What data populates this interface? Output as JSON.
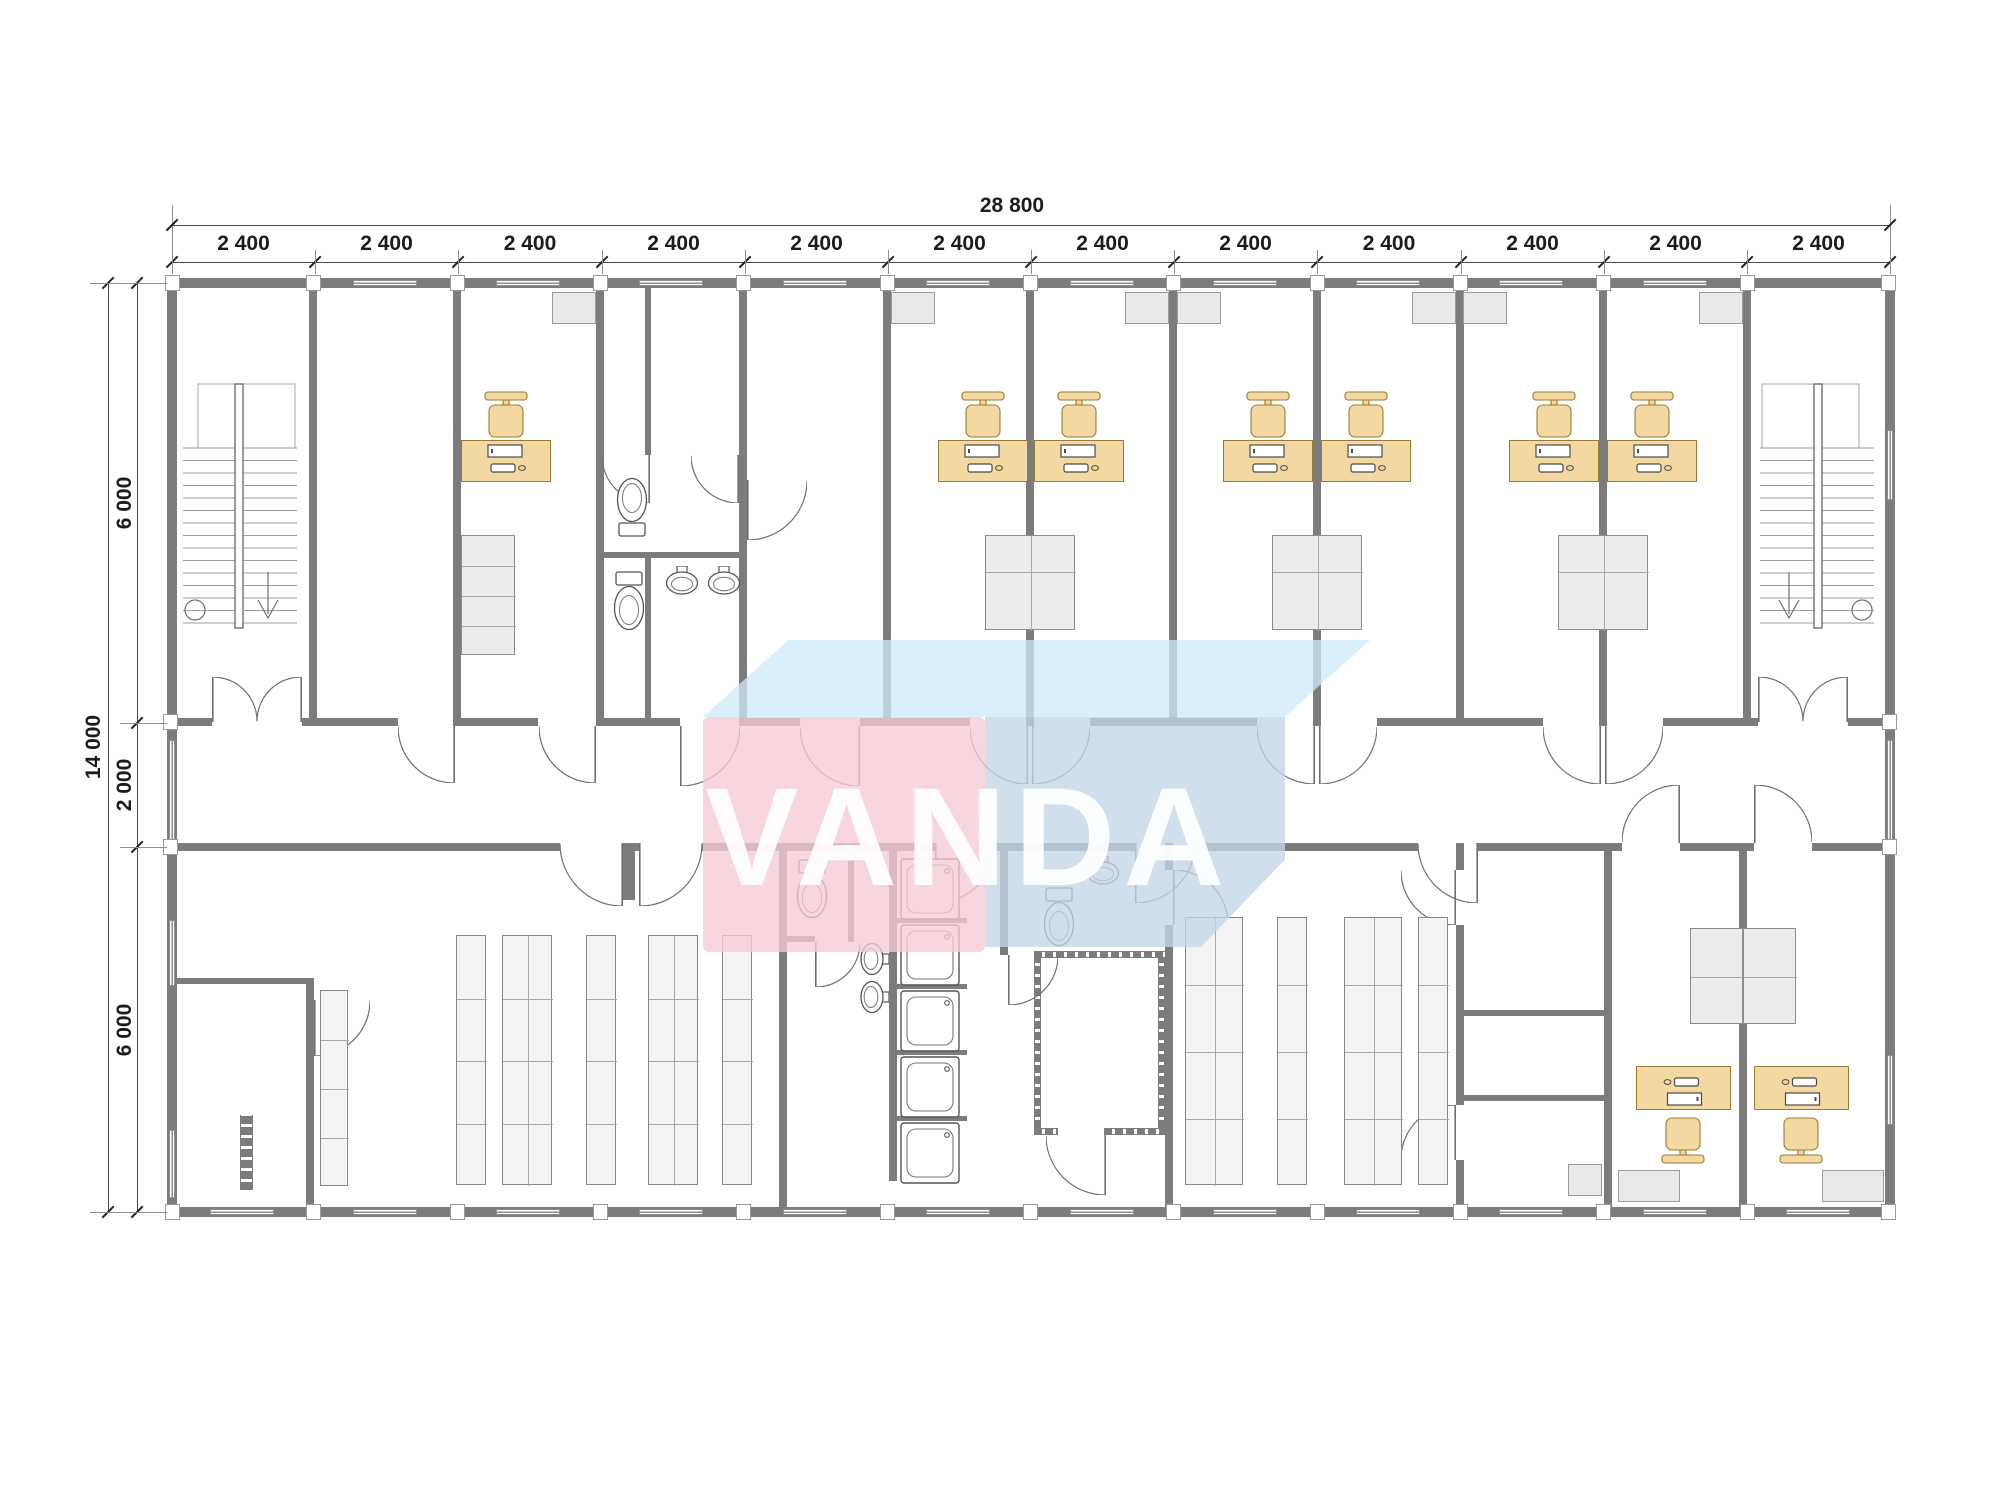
{
  "watermark": {
    "text": "VANDA",
    "colors": {
      "pink": "rgba(246,203,212,0.78)",
      "top_face": "rgba(206,233,248,0.75)",
      "side_face": "rgba(196,214,232,0.78)"
    }
  },
  "dims": {
    "top_total": {
      "label": "28 800",
      "x1": 172,
      "x2": 1890,
      "y": 225,
      "label_cx": 1012
    },
    "top_modules": {
      "label": "2 400",
      "y": 262,
      "bounds": [
        172,
        315,
        458,
        602,
        745,
        888,
        1031,
        1174,
        1317,
        1461,
        1604,
        1747,
        1890
      ]
    },
    "left_total": {
      "label": "14 000",
      "x": 108,
      "y1": 283,
      "y2": 1212,
      "label_cx": 95,
      "label_cy": 747
    },
    "left_modules": {
      "x": 137,
      "bounds": [
        283,
        723,
        847,
        1212
      ],
      "labels": [
        "6 000",
        "2 000",
        "6 000"
      ]
    }
  },
  "plan": {
    "wall_color": "#7c7c7c",
    "desk_fill": "#f3d9a1",
    "desk_stroke": "#9a7b33",
    "fixture_stroke": "#555555",
    "walls": [
      [
        167,
        278,
        1728,
        10
      ],
      [
        167,
        1207,
        1728,
        10
      ],
      [
        167,
        288,
        10,
        919
      ],
      [
        1885,
        288,
        10,
        919
      ],
      [
        167,
        718,
        45,
        8
      ],
      [
        302,
        718,
        96,
        8
      ],
      [
        455,
        718,
        83,
        8
      ],
      [
        596,
        718,
        84,
        8
      ],
      [
        740,
        718,
        60,
        8
      ],
      [
        860,
        718,
        110,
        8
      ],
      [
        1090,
        718,
        167,
        8
      ],
      [
        1377,
        718,
        166,
        8
      ],
      [
        1663,
        718,
        95,
        8
      ],
      [
        1848,
        718,
        47,
        8
      ],
      [
        167,
        843,
        393,
        8
      ],
      [
        623,
        843,
        16,
        8
      ],
      [
        702,
        843,
        233,
        8
      ],
      [
        995,
        843,
        140,
        8
      ],
      [
        1195,
        843,
        223,
        8
      ],
      [
        1478,
        843,
        144,
        8
      ],
      [
        1680,
        843,
        74,
        8
      ],
      [
        1812,
        843,
        83,
        8
      ],
      [
        309,
        288,
        8,
        438
      ],
      [
        453,
        288,
        8,
        438
      ],
      [
        596,
        288,
        8,
        438
      ],
      [
        739,
        288,
        8,
        438
      ],
      [
        883,
        288,
        8,
        438
      ],
      [
        1026,
        288,
        8,
        438
      ],
      [
        1169,
        288,
        8,
        438
      ],
      [
        1313,
        288,
        8,
        438
      ],
      [
        1456,
        288,
        8,
        438
      ],
      [
        1599,
        288,
        8,
        438
      ],
      [
        1743,
        288,
        8,
        438
      ],
      [
        645,
        288,
        6,
        167
      ],
      [
        596,
        552,
        151,
        6
      ],
      [
        645,
        558,
        6,
        160
      ],
      [
        779,
        843,
        8,
        374
      ],
      [
        889,
        851,
        8,
        330
      ],
      [
        1000,
        851,
        8,
        104
      ],
      [
        1165,
        843,
        8,
        27
      ],
      [
        1165,
        925,
        8,
        292
      ],
      [
        1456,
        843,
        8,
        27
      ],
      [
        1456,
        925,
        8,
        180
      ],
      [
        1456,
        1160,
        8,
        57
      ],
      [
        1604,
        843,
        8,
        374
      ],
      [
        1739,
        843,
        8,
        374
      ],
      [
        306,
        982,
        8,
        235
      ],
      [
        623,
        851,
        12,
        49
      ],
      [
        172,
        978,
        142,
        6
      ],
      [
        1464,
        1010,
        140,
        6
      ],
      [
        1464,
        1095,
        140,
        6
      ],
      [
        783,
        936,
        32,
        6
      ],
      [
        848,
        851,
        6,
        91
      ],
      [
        889,
        918,
        78,
        5
      ],
      [
        889,
        984,
        78,
        5
      ],
      [
        889,
        1050,
        78,
        5
      ],
      [
        889,
        1116,
        78,
        5
      ]
    ],
    "hatch": [
      [
        1034,
        951,
        131,
        7
      ],
      [
        1034,
        1128,
        24,
        7
      ],
      [
        1104,
        1128,
        61,
        7
      ],
      [
        1034,
        958,
        7,
        170
      ],
      [
        1158,
        958,
        7,
        170
      ],
      [
        240,
        1115,
        13,
        75
      ]
    ],
    "windows": [
      [
        353,
        280,
        64,
        6
      ],
      [
        496,
        280,
        64,
        6
      ],
      [
        639,
        280,
        64,
        6
      ],
      [
        783,
        280,
        64,
        6
      ],
      [
        926,
        280,
        64,
        6
      ],
      [
        1070,
        280,
        64,
        6
      ],
      [
        1213,
        280,
        64,
        6
      ],
      [
        1356,
        280,
        64,
        6
      ],
      [
        1499,
        280,
        64,
        6
      ],
      [
        1643,
        280,
        64,
        6
      ],
      [
        210,
        1209,
        64,
        6
      ],
      [
        353,
        1209,
        64,
        6
      ],
      [
        496,
        1209,
        64,
        6
      ],
      [
        639,
        1209,
        64,
        6
      ],
      [
        783,
        1209,
        64,
        6
      ],
      [
        926,
        1209,
        64,
        6
      ],
      [
        1070,
        1209,
        64,
        6
      ],
      [
        1213,
        1209,
        64,
        6
      ],
      [
        1356,
        1209,
        64,
        6
      ],
      [
        1499,
        1209,
        64,
        6
      ],
      [
        1643,
        1209,
        64,
        6
      ],
      [
        1786,
        1209,
        64,
        6
      ],
      [
        169,
        740,
        6,
        100
      ],
      [
        169,
        920,
        6,
        66
      ],
      [
        169,
        1130,
        6,
        68
      ],
      [
        1887,
        430,
        6,
        70
      ],
      [
        1887,
        740,
        6,
        100
      ],
      [
        1887,
        1055,
        6,
        70
      ]
    ],
    "joints": [
      [
        165,
        275
      ],
      [
        306,
        275
      ],
      [
        450,
        275
      ],
      [
        593,
        275
      ],
      [
        736,
        275
      ],
      [
        880,
        275
      ],
      [
        1023,
        275
      ],
      [
        1166,
        275
      ],
      [
        1310,
        275
      ],
      [
        1453,
        275
      ],
      [
        1596,
        275
      ],
      [
        1740,
        275
      ],
      [
        1881,
        275
      ],
      [
        165,
        1204
      ],
      [
        306,
        1204
      ],
      [
        450,
        1204
      ],
      [
        593,
        1204
      ],
      [
        736,
        1204
      ],
      [
        880,
        1204
      ],
      [
        1023,
        1204
      ],
      [
        1166,
        1204
      ],
      [
        1310,
        1204
      ],
      [
        1453,
        1204
      ],
      [
        1596,
        1204
      ],
      [
        1740,
        1204
      ],
      [
        1881,
        1204
      ],
      [
        163,
        714
      ],
      [
        163,
        839
      ],
      [
        1882,
        714
      ],
      [
        1882,
        839
      ]
    ],
    "doors": [
      [
        212,
        677,
        45,
        1,
        -1
      ],
      [
        257,
        677,
        45,
        -1,
        -1
      ],
      [
        1758,
        677,
        45,
        1,
        -1
      ],
      [
        1803,
        677,
        45,
        -1,
        -1
      ],
      [
        398,
        726,
        57,
        -1,
        1
      ],
      [
        539,
        726,
        57,
        -1,
        1
      ],
      [
        680,
        726,
        60,
        1,
        1
      ],
      [
        800,
        726,
        60,
        -1,
        1
      ],
      [
        970,
        726,
        58,
        -1,
        1
      ],
      [
        1032,
        726,
        58,
        1,
        1
      ],
      [
        1257,
        726,
        58,
        -1,
        1
      ],
      [
        1319,
        726,
        58,
        1,
        1
      ],
      [
        1543,
        726,
        58,
        -1,
        1
      ],
      [
        1605,
        726,
        58,
        1,
        1
      ],
      [
        560,
        843,
        63,
        -1,
        1
      ],
      [
        639,
        843,
        63,
        1,
        1
      ],
      [
        935,
        843,
        60,
        1,
        1
      ],
      [
        1135,
        843,
        60,
        1,
        1
      ],
      [
        1418,
        843,
        60,
        -1,
        1
      ],
      [
        1622,
        785,
        58,
        -1,
        -1
      ],
      [
        1754,
        785,
        58,
        1,
        -1
      ],
      [
        602,
        455,
        48,
        -1,
        1
      ],
      [
        691,
        455,
        48,
        -1,
        1
      ],
      [
        747,
        480,
        60,
        1,
        1
      ],
      [
        314,
        1000,
        56,
        1,
        1
      ],
      [
        1401,
        870,
        55,
        -1,
        1
      ],
      [
        1401,
        1105,
        55,
        -1,
        -1
      ],
      [
        1173,
        870,
        55,
        1,
        -1
      ],
      [
        1046,
        1135,
        60,
        -1,
        1
      ],
      [
        815,
        942,
        45,
        1,
        1
      ],
      [
        1008,
        955,
        50,
        1,
        1
      ]
    ],
    "desks": [
      [
        461,
        440,
        90,
        42,
        0
      ],
      [
        938,
        440,
        90,
        42,
        0
      ],
      [
        1034,
        440,
        90,
        42,
        0
      ],
      [
        1223,
        440,
        90,
        42,
        0
      ],
      [
        1321,
        440,
        90,
        42,
        0
      ],
      [
        1509,
        440,
        90,
        42,
        0
      ],
      [
        1607,
        440,
        90,
        42,
        0
      ],
      [
        1636,
        1066,
        95,
        44,
        180
      ],
      [
        1754,
        1066,
        95,
        44,
        180
      ]
    ],
    "chairs": [
      [
        483,
        391,
        0
      ],
      [
        960,
        391,
        0
      ],
      [
        1056,
        391,
        0
      ],
      [
        1245,
        391,
        0
      ],
      [
        1343,
        391,
        0
      ],
      [
        1531,
        391,
        0
      ],
      [
        1629,
        391,
        0
      ],
      [
        1660,
        1116,
        180
      ],
      [
        1778,
        1116,
        180
      ]
    ],
    "wardrobes": [
      [
        461,
        535,
        54,
        120,
        1
      ],
      [
        985,
        535,
        90,
        95,
        2
      ],
      [
        1272,
        535,
        90,
        95,
        2
      ],
      [
        1558,
        535,
        90,
        95,
        2
      ],
      [
        1690,
        928,
        53,
        96,
        1
      ],
      [
        1743,
        928,
        53,
        96,
        1
      ]
    ],
    "racks": [
      [
        456,
        935,
        30,
        250,
        1
      ],
      [
        502,
        935,
        50,
        250,
        2
      ],
      [
        586,
        935,
        30,
        250,
        1
      ],
      [
        648,
        935,
        50,
        250,
        2
      ],
      [
        722,
        935,
        30,
        250,
        1
      ],
      [
        320,
        990,
        28,
        196,
        1
      ],
      [
        1185,
        917,
        58,
        268,
        2
      ],
      [
        1277,
        917,
        30,
        268,
        1
      ],
      [
        1344,
        917,
        58,
        268,
        2
      ],
      [
        1418,
        917,
        30,
        268,
        1
      ]
    ],
    "toilets": [
      [
        613,
        474,
        180
      ],
      [
        610,
        570,
        0
      ],
      [
        793,
        858,
        0
      ],
      [
        1040,
        886,
        0
      ]
    ],
    "sinks": [
      [
        664,
        566,
        0
      ],
      [
        706,
        566,
        0
      ],
      [
        856,
        944,
        90
      ],
      [
        856,
        982,
        90
      ],
      [
        1085,
        856,
        0
      ]
    ],
    "showers": [
      [
        900,
        858
      ],
      [
        900,
        924
      ],
      [
        900,
        990
      ],
      [
        900,
        1056
      ],
      [
        900,
        1122
      ]
    ],
    "acs": [
      [
        552,
        292,
        44,
        32
      ],
      [
        891,
        292,
        44,
        32
      ],
      [
        1125,
        292,
        44,
        32
      ],
      [
        1177,
        292,
        44,
        32
      ],
      [
        1412,
        292,
        44,
        32
      ],
      [
        1463,
        292,
        44,
        32
      ],
      [
        1699,
        292,
        44,
        32
      ],
      [
        1618,
        1170,
        62,
        32
      ],
      [
        1822,
        1170,
        62,
        32
      ],
      [
        1568,
        1164,
        34,
        32
      ]
    ],
    "stairs": [
      {
        "x": 180,
        "y": 380,
        "w": 120,
        "h": 268,
        "m": 1
      },
      {
        "x": 1757,
        "y": 380,
        "w": 120,
        "h": 268,
        "m": -1
      }
    ]
  }
}
